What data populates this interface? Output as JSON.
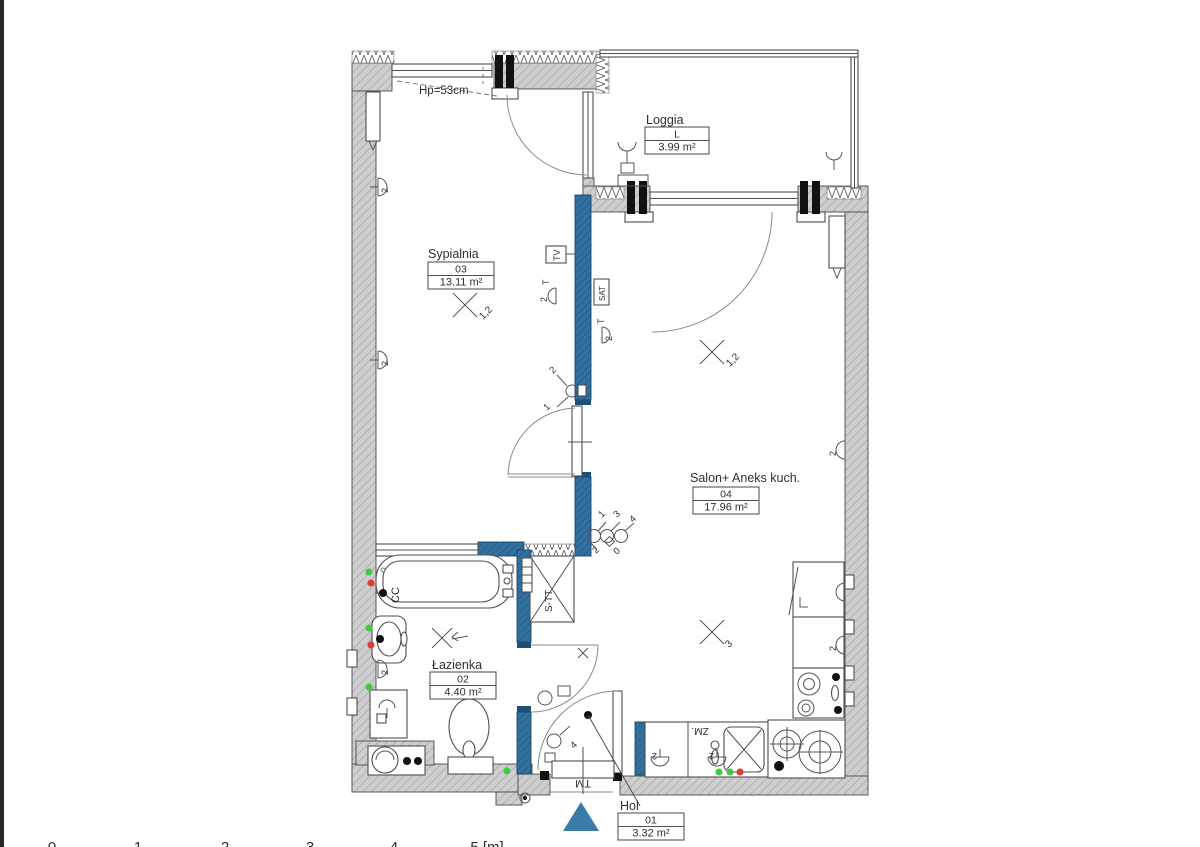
{
  "rooms": {
    "loggia": {
      "title": "Loggia",
      "code": "L",
      "area": "3.99 m²"
    },
    "sypialnia": {
      "title": "Sypialnia",
      "code": "03",
      "area": "13.11 m²"
    },
    "salon": {
      "title": "Salon+ Aneks kuch.",
      "code": "04",
      "area": "17.96 m²"
    },
    "lazienka": {
      "title": "Łazienka",
      "code": "02",
      "area": "4.40 m²"
    },
    "hol": {
      "title": "Hol",
      "code": "01",
      "area": "3.32 m²"
    }
  },
  "annotations": {
    "sill_height": "Hp=53cm",
    "shaft": "S-TT",
    "doormat": "TM",
    "sink_unit": "ZM.",
    "bath_conn": "CC",
    "tv": "TV",
    "t": "T",
    "sat": "SAT"
  },
  "electrical": {
    "socket": "2",
    "switch1": "1",
    "switch2": "2",
    "switch3": "3",
    "switch4": "4",
    "switch0": "0",
    "ceiling_group_a": "1,2",
    "ceiling_group_b": "3"
  },
  "scale": {
    "labels": [
      "0",
      "1",
      "2",
      "3",
      "4",
      "5 [m]"
    ]
  },
  "colors": {
    "wall_gray": "#cecece",
    "partition_blue": "#31719f",
    "entrance_marker": "#3a7ba9",
    "status_green": "#3ecb3e",
    "status_red": "#e23b30"
  }
}
